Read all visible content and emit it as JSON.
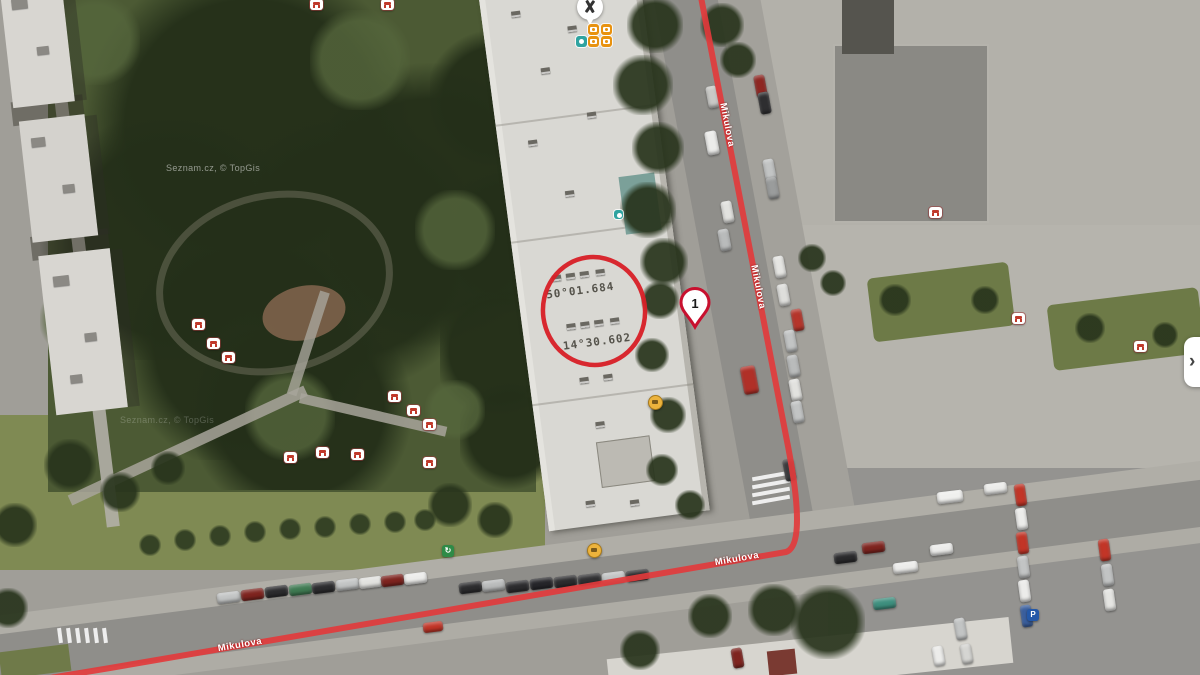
{
  "attribution": {
    "text": "Seznam.cz, © TopGis"
  },
  "streets": {
    "label": "Mikulova"
  },
  "route_marker": {
    "label": "1"
  },
  "roof_coordinates": {
    "line1": "50°01.684",
    "line2": "14°30.602"
  },
  "annotation": {
    "shape": "red-circle",
    "color": "#d81f26"
  },
  "route": {
    "color": "#e23b3c"
  },
  "icons": {
    "bench": "bench-icon (css shape)",
    "photo_poi": "camera-icon (css shape)",
    "poi_pin": "map-pin-icon (css shape)",
    "sport_poi": "teal-poi-icon (css shape)",
    "amenity_poi": "yellow-poi-icon (css shape)",
    "recycling_poi": "↻",
    "parking_poi": "P",
    "panel_toggle": "›"
  }
}
